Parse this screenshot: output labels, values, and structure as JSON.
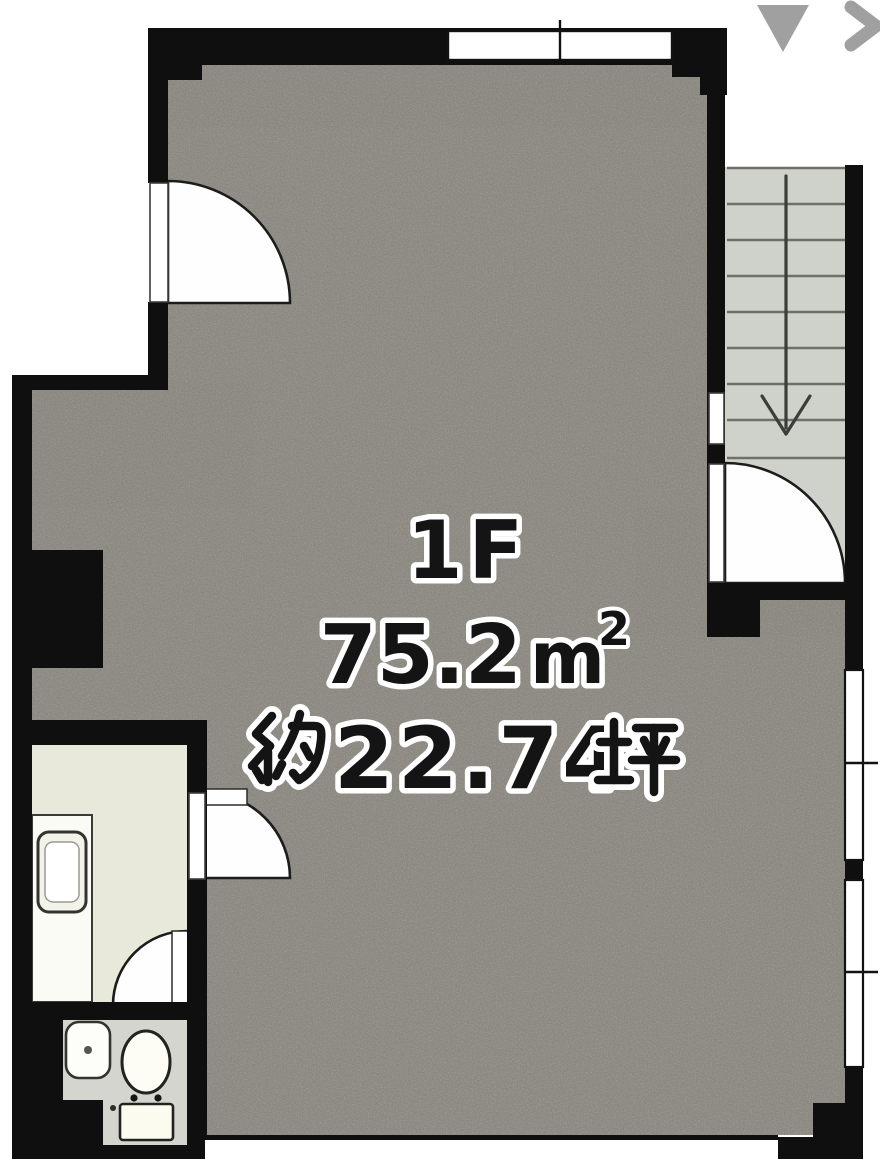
{
  "page": {
    "type": "floorplan-photo-viewer",
    "background_color": "#ffffff"
  },
  "overlay": {
    "collapse_icon": "triangle-down",
    "next_icon": "chevron-right",
    "icon_color": "#a0a0a0"
  },
  "floorplan": {
    "floor_label": "1F",
    "area_m2": {
      "label": "75.2㎡",
      "value": "75.2",
      "unit_letter": "m",
      "unit_exponent": "2"
    },
    "area_tsubo": {
      "label": "約22.74坪",
      "prefix": "約",
      "value": "22.74",
      "unit": "坪"
    },
    "rooms": [
      "main-room",
      "stairwell",
      "kitchen",
      "toilet"
    ],
    "stairs": {
      "direction": "down",
      "treads": 8
    },
    "colors": {
      "wall": "#0f0f0f",
      "main_floor": "#8f8d85",
      "stairs_floor": "#ced2cb",
      "kitchen_floor": "#e8e9da",
      "toilet_floor": "#d4d5ce",
      "fixture_white": "#fdfdfa",
      "label_text": "#141414",
      "label_outline": "#ffffff"
    }
  }
}
